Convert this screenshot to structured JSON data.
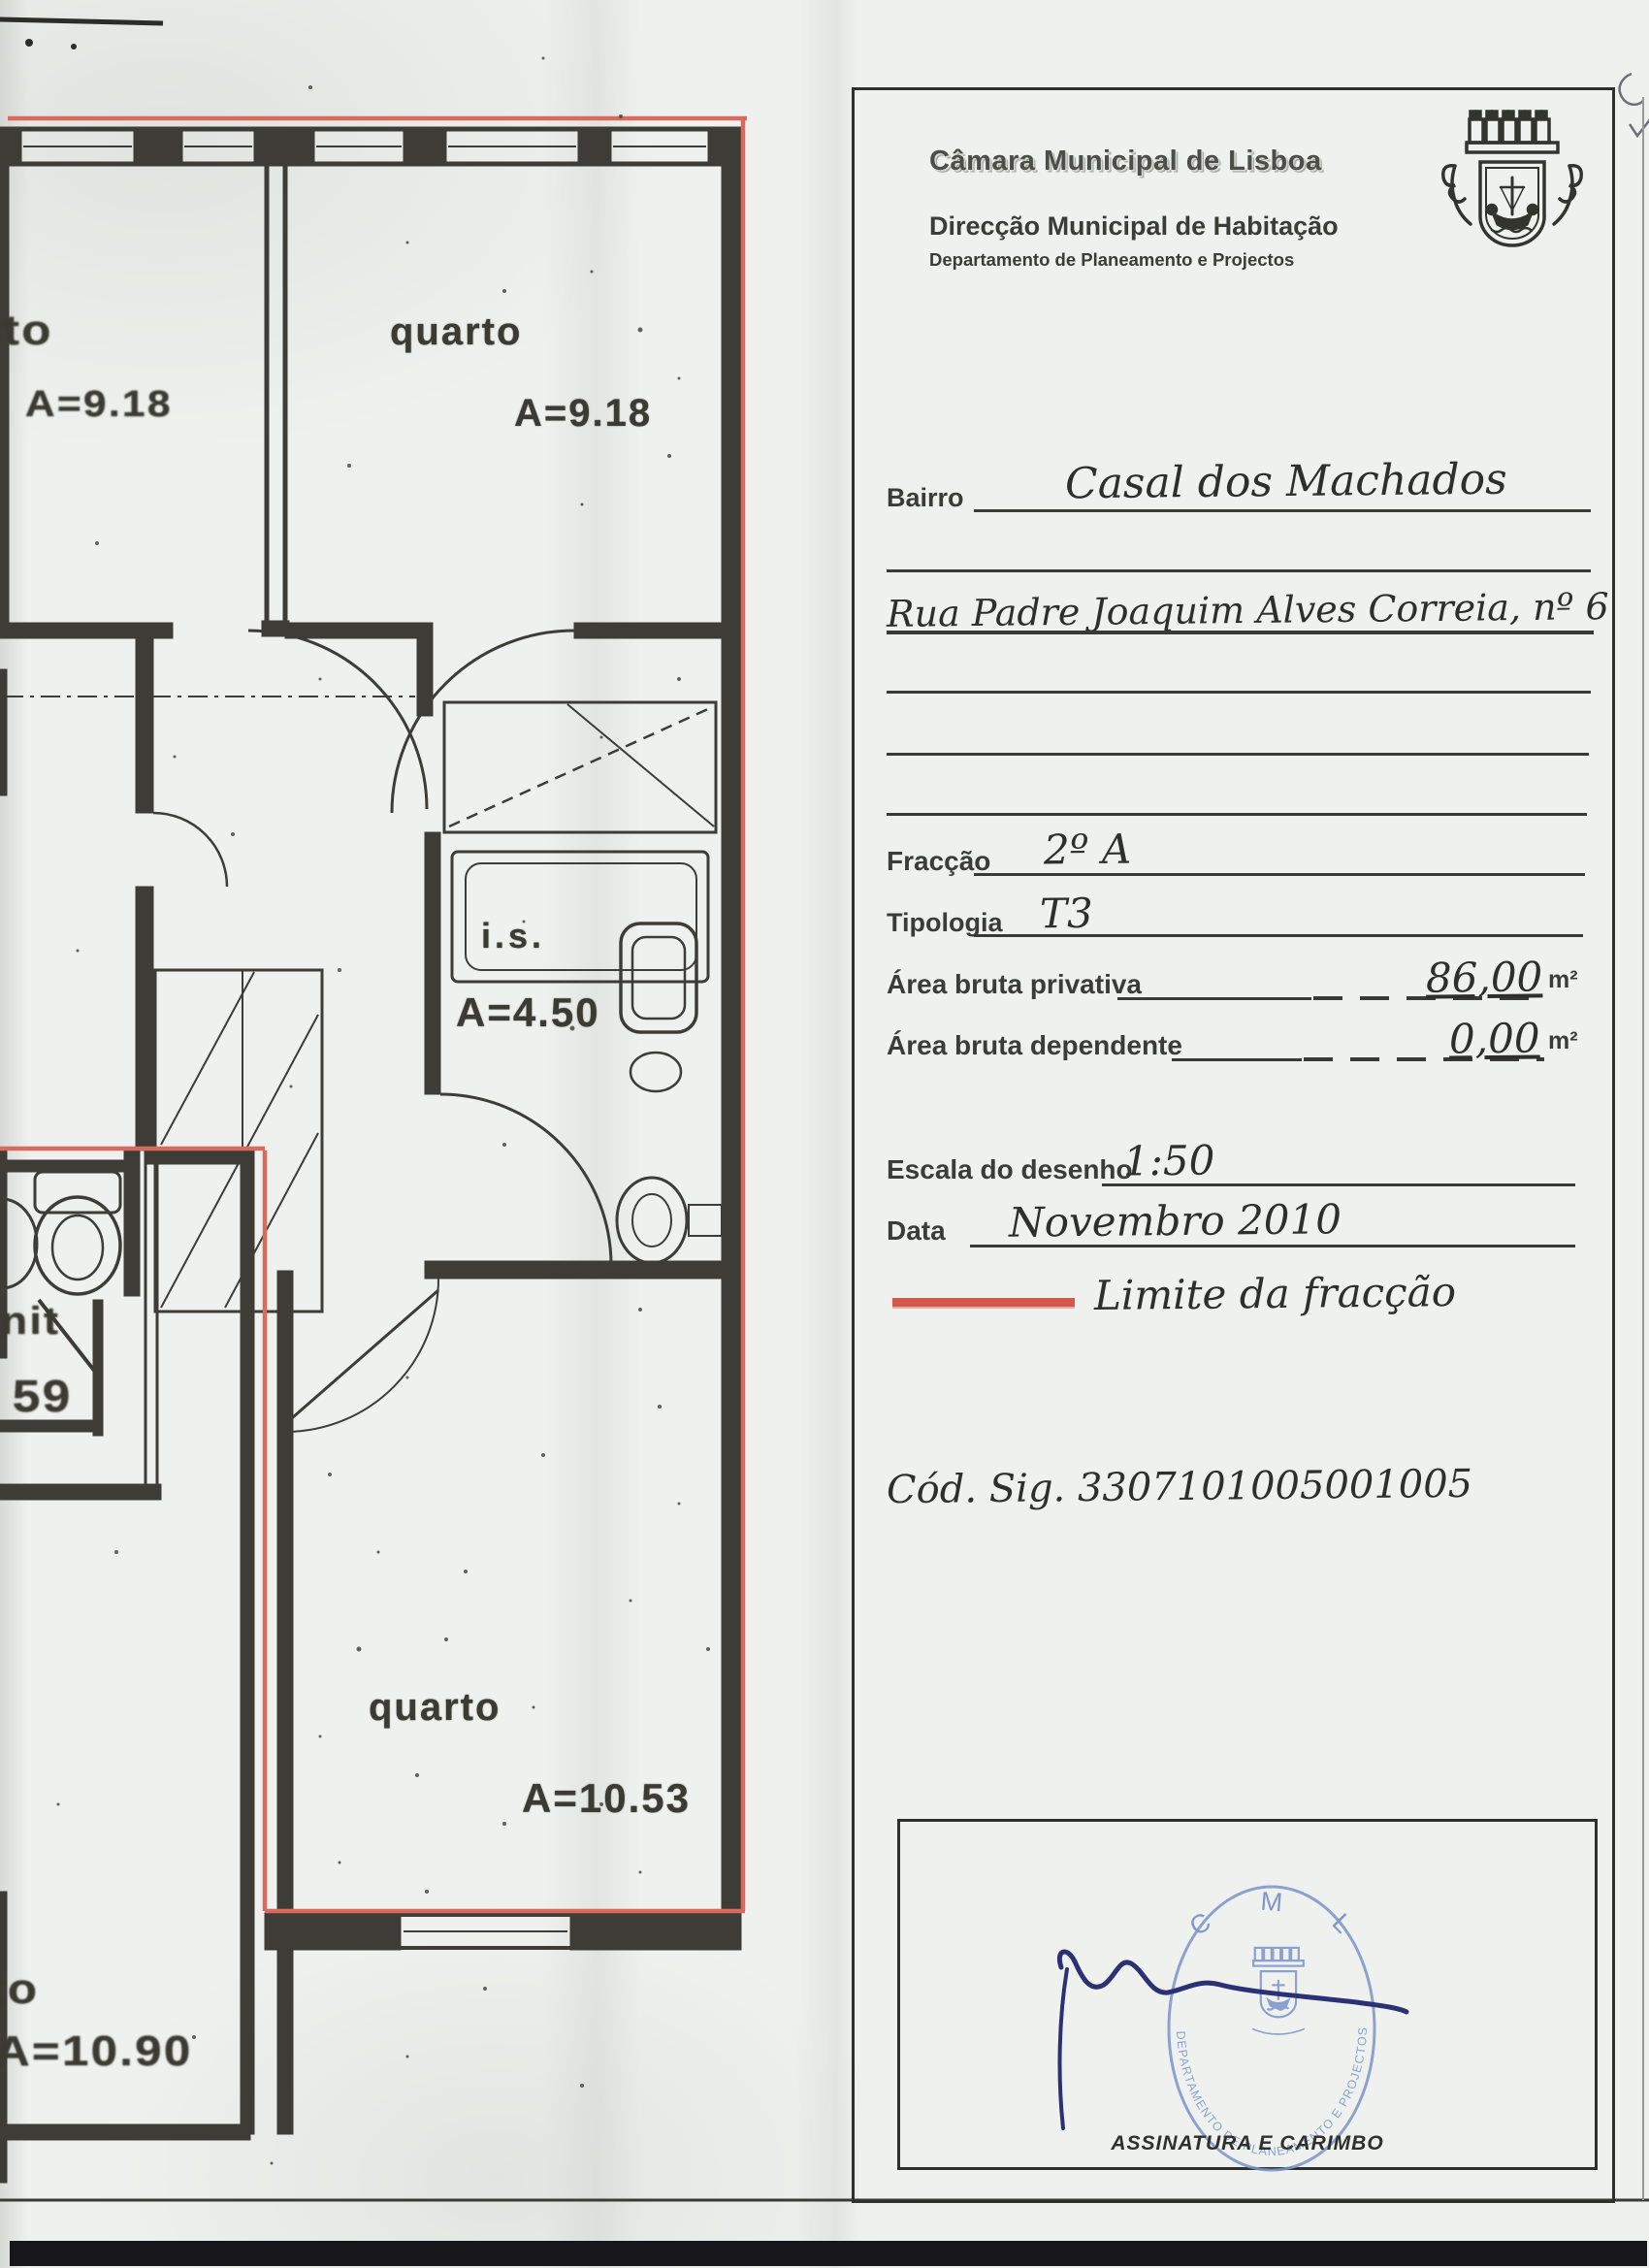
{
  "header": {
    "org": "Câmara Municipal de Lisboa",
    "direction": "Direcção Municipal de Habitação",
    "department": "Departamento de Planeamento e Projectos"
  },
  "form": {
    "bairro_label": "Bairro",
    "bairro_value": "Casal dos Machados",
    "address_value": "Rua Padre Joaquim Alves Correia, nº 6",
    "fraccao_label": "Fracção",
    "fraccao_value": "2º A",
    "tipologia_label": "Tipologia",
    "tipologia_value": "T3",
    "area_privativa_label": "Área bruta privativa",
    "area_privativa_value": "86,00",
    "area_dependente_label": "Área bruta dependente",
    "area_dependente_value": "0,00",
    "area_unit": "m²",
    "escala_label": "Escala do desenho",
    "escala_value": "1:50",
    "data_label": "Data",
    "data_value": "Novembro 2010",
    "legend_label": "Limite da fracção",
    "cod_sig": "Cód. Sig. 3307101005001005"
  },
  "signature": {
    "caption": "ASSINATURA E CARIMBO",
    "stamp_top": "C M L",
    "stamp_ring": "DEPARTAMENTO DE PLANEAMENTO E PROJECTOS"
  },
  "plan": {
    "labels": [
      {
        "text": "rto"
      },
      {
        "text": "A=9.18"
      },
      {
        "text": "quarto"
      },
      {
        "text": "A=9.18"
      },
      {
        "text": "i.s."
      },
      {
        "text": "A=4.50"
      },
      {
        "text": "nit"
      },
      {
        "text": "59"
      },
      {
        "text": "quarto"
      },
      {
        "text": "A=10.53"
      },
      {
        "text": "to"
      },
      {
        "text": "A=10.90"
      }
    ]
  },
  "colors": {
    "limit_red": "#d96a5e",
    "wall_dark": "#3d3c36",
    "stamp_blue": "#7b94cb",
    "ink_blue": "#2b3172"
  }
}
